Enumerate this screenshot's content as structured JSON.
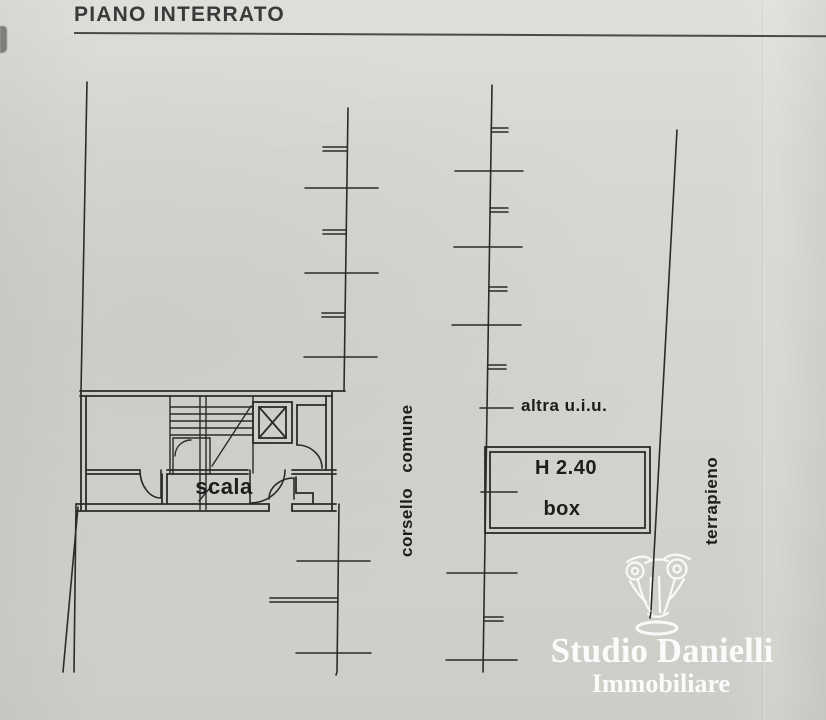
{
  "page": {
    "title": "PIANO INTERRATO",
    "paper_color": "#d6d8d2",
    "line_color": "#2b2b2b"
  },
  "plan": {
    "labels": {
      "scala": "scala",
      "corsello_comune": "corsello comune",
      "altra_uiu": "altra u.i.u.",
      "box_height": "H 2.40",
      "box": "box",
      "terrapieno": "terrapieno"
    }
  },
  "watermark": {
    "agency_name": "Studio Danielli",
    "agency_subtitle": "Immobiliare",
    "icon": "corinthian-capital-icon",
    "color": "#ffffff"
  }
}
